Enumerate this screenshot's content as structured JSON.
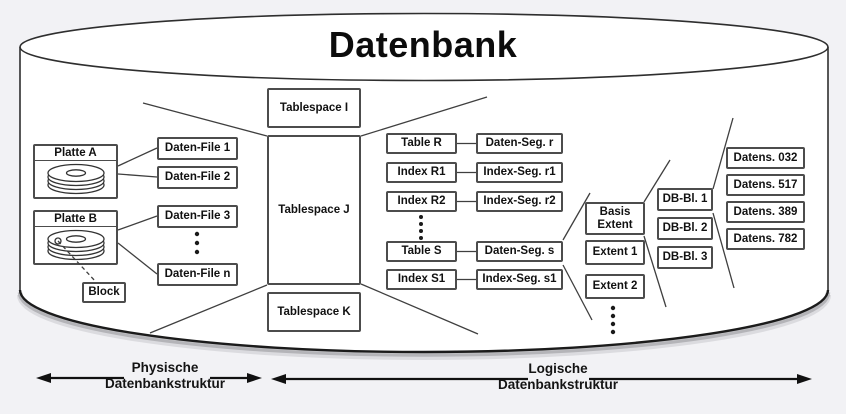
{
  "title": "Datenbank",
  "colors": {
    "ink": "#1a1a1a",
    "background": "#f2f2f5",
    "box_border": "#4c4c4c",
    "box_fill": "#ffffff"
  },
  "physical": {
    "platte_a": "Platte A",
    "platte_b": "Platte B",
    "block": "Block",
    "daten_files": [
      "Daten-File 1",
      "Daten-File 2",
      "Daten-File 3",
      "Daten-File n"
    ]
  },
  "tablespaces": [
    "Tablespace I",
    "Tablespace J",
    "Tablespace K"
  ],
  "tables": [
    "Table R",
    "Index R1",
    "Index R2",
    "Table S",
    "Index S1"
  ],
  "segments": [
    "Daten-Seg. r",
    "Index-Seg. r1",
    "Index-Seg. r2",
    "Daten-Seg. s",
    "Index-Seg. s1"
  ],
  "extents": [
    "Basis\nExtent",
    "Extent 1",
    "Extent 2"
  ],
  "db_blocks": [
    "DB-Bl. 1",
    "DB-Bl. 2",
    "DB-Bl. 3"
  ],
  "records": [
    "Datens. 032",
    "Datens. 517",
    "Datens. 389",
    "Datens. 782"
  ],
  "legend": {
    "physical": "Physische\nDatenbankstruktur",
    "logical": "Logische\nDatenbankstruktur"
  }
}
